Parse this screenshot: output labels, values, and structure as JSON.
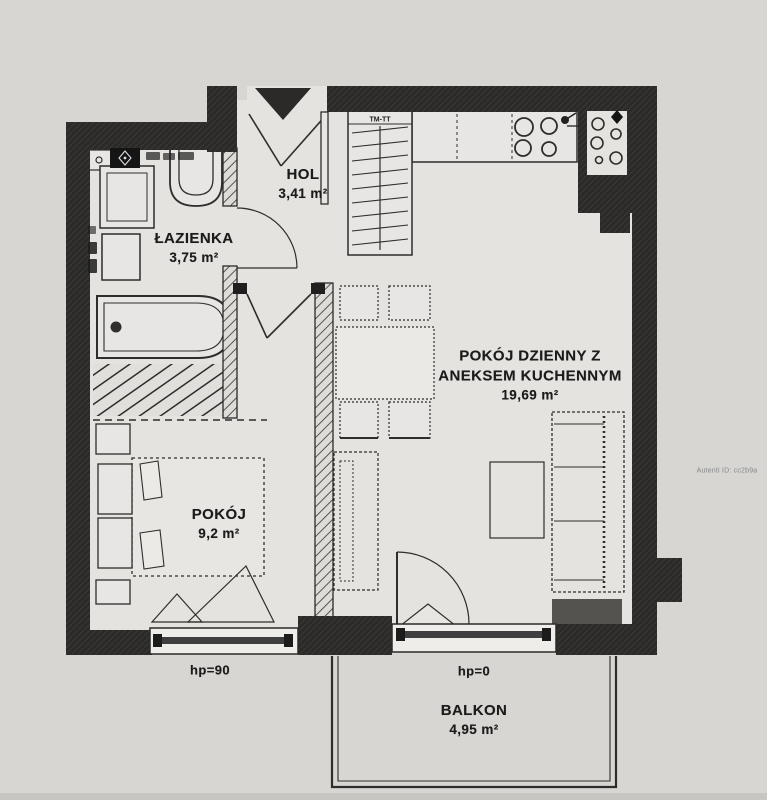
{
  "page": {
    "type": "apartment-floor-plan",
    "background": "#d7d6d3"
  },
  "colors": {
    "wall": "#2b2a28",
    "line": "#2e2d2b",
    "interior": "#e4e3e0",
    "text": "#1b1b1b",
    "watermark_text": "#84868a"
  },
  "rooms": {
    "hol": {
      "name": "HOL",
      "area": "3,41 m²"
    },
    "bathroom": {
      "name": "ŁAZIENKA",
      "area": "3,75 m²"
    },
    "living": {
      "line1": "POKÓJ DZIENNY Z",
      "line2": "ANEKSEM KUCHENNYM",
      "area": "19,69 m²"
    },
    "bedroom": {
      "name": "POKÓJ",
      "area": "9,2 m²"
    },
    "balcony": {
      "name": "BALKON",
      "area": "4,95 m²"
    }
  },
  "labels": {
    "bedroom_window": "hp=90",
    "balcony_door": "hp=0",
    "shaft": "TM-TT"
  },
  "watermark": {
    "text": "Autenti ID: cc2b9a"
  }
}
